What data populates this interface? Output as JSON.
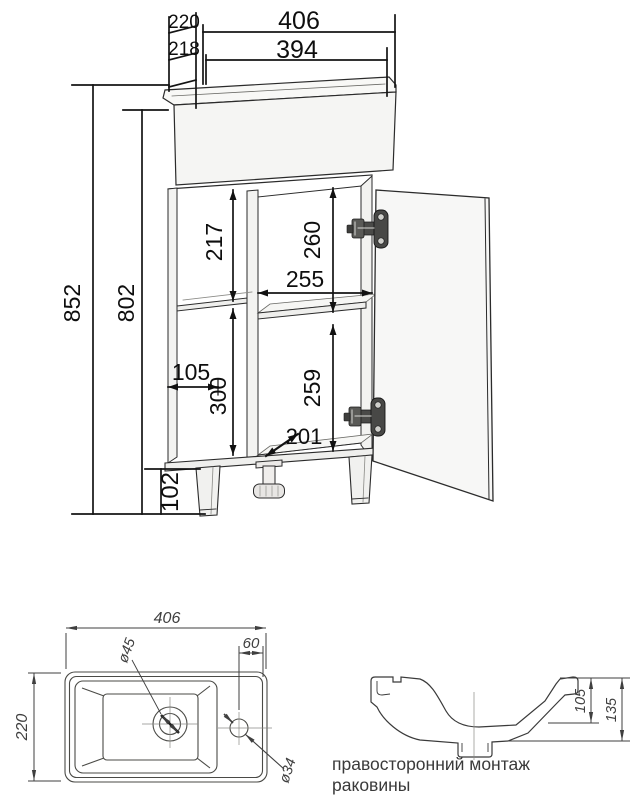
{
  "main_view": {
    "dim_width_top": "406",
    "dim_width_inner": "394",
    "dim_depth_top": "220",
    "dim_depth_inner": "218",
    "dim_height_total": "852",
    "dim_height_body": "802",
    "dim_upper_left_section": "217",
    "dim_upper_right_section": "260",
    "dim_opening_width": "255",
    "dim_side_shelf_depth": "105",
    "dim_lower_left_section": "300",
    "dim_lower_right_section": "259",
    "dim_bottom_depth": "201",
    "dim_leg_height": "102"
  },
  "top_view": {
    "dim_width": "406",
    "dim_depth": "220",
    "dim_tap_offset": "60",
    "dim_drain_diameter": "ø45",
    "dim_tap_hole_diameter": "ø34"
  },
  "side_view": {
    "dim_basin_depth": "105",
    "dim_total_depth": "135"
  },
  "caption": "правосторонний монтаж раковины",
  "colors": {
    "background": "#ffffff",
    "object_lines": "#2b2b2b",
    "dimension_text": "#0e0e0e",
    "sub_drawing_lines": "#3f3f3f"
  }
}
